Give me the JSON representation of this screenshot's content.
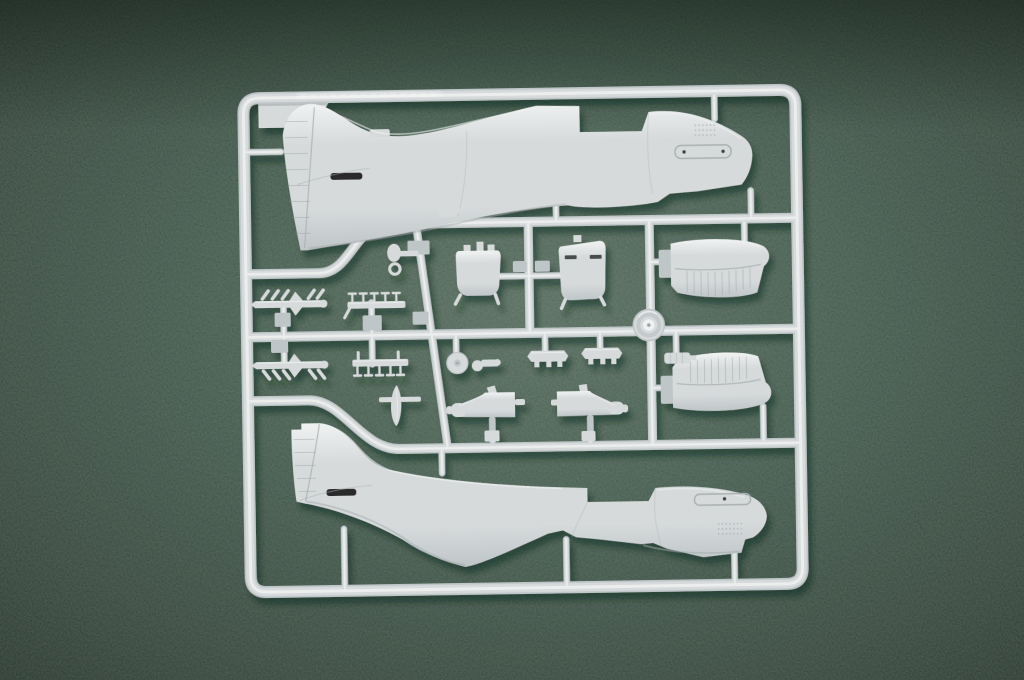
{
  "scene": {
    "title": "Plastic model kit sprue with two aircraft fuselage halves and detail parts on green felt"
  },
  "colors": {
    "felt_mid": "#557663",
    "felt_deep": "#2d4236",
    "felt_light": "#6f8d7a",
    "plastic_base": "#d6dadb",
    "plastic_light": "#f0f2f2",
    "plastic_mid": "#bfc6c8",
    "plastic_dark": "#9aa2a5",
    "panel_line": "#a9afb2",
    "recess_dark": "#1a1c1d"
  },
  "shadow": {
    "dx": "4",
    "dy": "7",
    "blur": "3",
    "color": "#0f221a",
    "opacity": "0.45"
  },
  "parts": {
    "frame": {
      "label": "sprue outer frame"
    },
    "label_plate": {
      "label": "sprue label plate"
    },
    "fuselage_top": {
      "label": "fuselage half, right side"
    },
    "fuselage_bottom": {
      "label": "fuselage half, left side with radiator scoop"
    },
    "stab_upper": {
      "label": "horizontal stabilizer half"
    },
    "stab_lower": {
      "label": "horizontal stabilizer half, mirrored"
    },
    "wheel": {
      "label": "main wheel hub"
    },
    "exhaust_1": {
      "label": "exhaust stack strip"
    },
    "exhaust_2": {
      "label": "exhaust stack strip, mirrored"
    },
    "pins_1": {
      "label": "small pin strip"
    },
    "pins_2": {
      "label": "small pin strip, mirrored"
    },
    "radiator_a": {
      "label": "radiator core part"
    },
    "radiator_b": {
      "label": "radiator housing part"
    },
    "doors_1": {
      "label": "landing gear door"
    },
    "doors_2": {
      "label": "landing gear door, mirrored"
    },
    "disc": {
      "label": "brake disc"
    },
    "tailwheel_asm": {
      "label": "tail wheel assembly"
    },
    "tailwheel_ring": {
      "label": "tail wheel fork with ring"
    },
    "prop_blade": {
      "label": "propeller blade"
    },
    "sight_1": {
      "label": "cowl machine gun part"
    },
    "sight_2": {
      "label": "cowl machine gun part, mirrored"
    },
    "bracket": {
      "label": "small bracket"
    },
    "strut": {
      "label": "oleo strut part"
    }
  }
}
